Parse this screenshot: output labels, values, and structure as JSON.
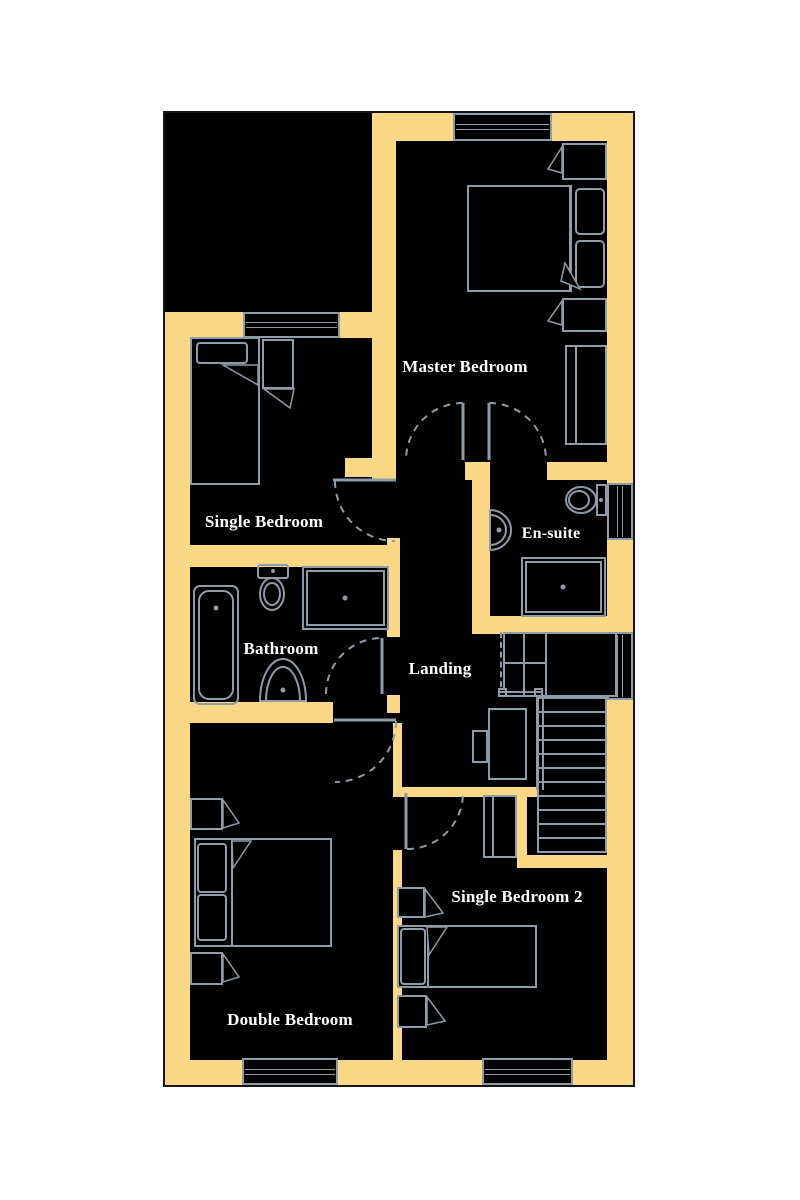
{
  "title": "First floor plan",
  "colors": {
    "wall": "#FBD886",
    "line": "#8E9CA8",
    "room_fill": "#000000",
    "background": "#FFFFFF",
    "label_text": "#FFFFFF",
    "outline": "#151515"
  },
  "rooms": [
    {
      "id": "master-bedroom",
      "label": "Master Bedroom"
    },
    {
      "id": "single-bedroom",
      "label": "Single Bedroom"
    },
    {
      "id": "en-suite",
      "label": "En-suite"
    },
    {
      "id": "bathroom",
      "label": "Bathroom"
    },
    {
      "id": "landing",
      "label": "Landing"
    },
    {
      "id": "single-bedroom-2",
      "label": "Single Bedroom 2"
    },
    {
      "id": "double-bedroom",
      "label": "Double Bedroom"
    }
  ],
  "fixtures": {
    "master_bedroom": [
      "double-bed",
      "pillows",
      "bedside-table",
      "bedside-table",
      "wardrobe"
    ],
    "single_bedroom": [
      "single-bed",
      "bedside-table"
    ],
    "en_suite": [
      "toilet",
      "corner-basin",
      "shower"
    ],
    "bathroom": [
      "bathtub",
      "toilet",
      "shower",
      "basin"
    ],
    "landing": [
      "staircase",
      "cupboard",
      "desk-unit"
    ],
    "single_bedroom_2": [
      "single-bed",
      "bedside-table",
      "bedside-table",
      "cupboard"
    ],
    "double_bedroom": [
      "double-bed",
      "bedside-table",
      "bedside-table"
    ]
  },
  "counts": {
    "windows": 6,
    "door_swings": 6
  }
}
